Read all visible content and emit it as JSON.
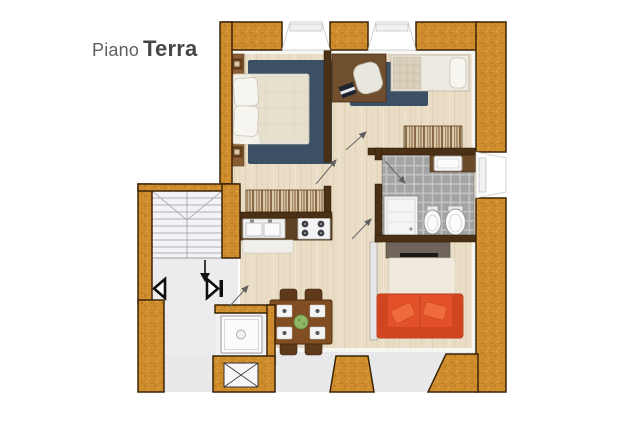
{
  "title": {
    "prefix": "Piano",
    "name": "Terra"
  },
  "floor_plan": {
    "kind": "apartment-floor-plan",
    "floor_label": "Piano Terra",
    "rooms": [
      {
        "name": "master-bedroom",
        "furniture": [
          "double-bed",
          "pillows",
          "blue-rug",
          "headboard-panel",
          "wardrobe"
        ]
      },
      {
        "name": "study-bedroom",
        "furniture": [
          "desk",
          "office-chair",
          "laptop",
          "blue-rug",
          "single-bed",
          "radiator-dresser"
        ]
      },
      {
        "name": "bathroom",
        "furniture": [
          "washbasin-counter",
          "shower",
          "bidet",
          "toilet"
        ],
        "floor": "gray-tiles"
      },
      {
        "name": "kitchen-dining",
        "furniture": [
          "kitchen-counter",
          "double-sink",
          "gas-hob",
          "dishwasher",
          "dining-table",
          "chairs",
          "plates",
          "plant"
        ]
      },
      {
        "name": "living-room",
        "furniture": [
          "tv-cabinet",
          "tv",
          "cream-rug",
          "orange-sofa",
          "sofa-cushions"
        ]
      },
      {
        "name": "stairwell",
        "furniture": [
          "staircase",
          "direction-arrow",
          "entry-arrows",
          "elevator-shaft",
          "laundry-basin"
        ]
      }
    ],
    "symbols": [
      "window-openings",
      "door-swing-arrows",
      "stair-down-arrow",
      "elevator-cross"
    ],
    "colors": {
      "wall_orange": "#cf8c2c",
      "wall_outline": "#3a2509",
      "wood_floor": "#eaddc6",
      "tile_gray": "#a3a3a3",
      "rug_blue": "#3c5065",
      "rug_cream": "#efeadd",
      "sofa_orange": "#e2512a",
      "counter_brown": "#5c4123",
      "table_brown": "#804e22",
      "cabinet_taupe": "#6e6459",
      "title_gray": "#474747"
    }
  }
}
